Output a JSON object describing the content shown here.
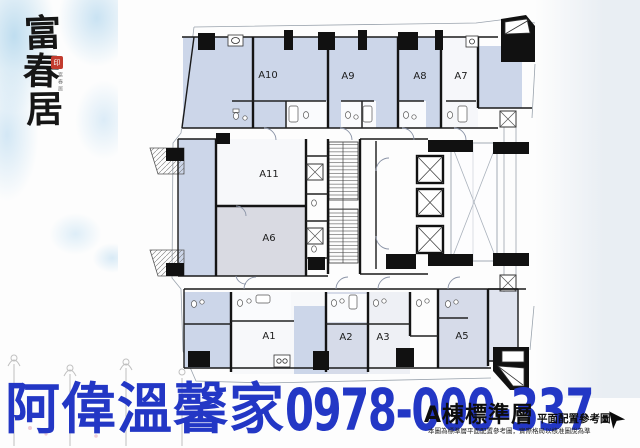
{
  "branding": {
    "title": "富春居",
    "title_chars": [
      "富",
      "春",
      "居"
    ],
    "seal_text": "印",
    "inscription": "富春居"
  },
  "plan": {
    "units": [
      {
        "id": "A10",
        "label": "A10"
      },
      {
        "id": "A9",
        "label": "A9"
      },
      {
        "id": "A8",
        "label": "A8"
      },
      {
        "id": "A7",
        "label": "A7"
      },
      {
        "id": "A11",
        "label": "A11"
      },
      {
        "id": "A6",
        "label": "A6"
      },
      {
        "id": "A1",
        "label": "A1"
      },
      {
        "id": "A2",
        "label": "A2"
      },
      {
        "id": "A3",
        "label": "A3"
      },
      {
        "id": "A5",
        "label": "A5"
      }
    ],
    "caption": {
      "building": "A棟",
      "floor": "標準層",
      "sub": "平面配置參考圖"
    },
    "disclaimer": "本圖為標準層平面配置參考圖，實際格局以核准圖說為準",
    "colors": {
      "room_fill": "#ccd6e9",
      "room_fill_gray": "#d9dae2",
      "wall": "#141414",
      "thin_line": "#9aa3ad"
    }
  },
  "watermark": {
    "agency": "阿偉溫馨家",
    "phone": "0978-000-337",
    "color": "#2337c5"
  },
  "icons": {
    "cursor": "➤"
  }
}
